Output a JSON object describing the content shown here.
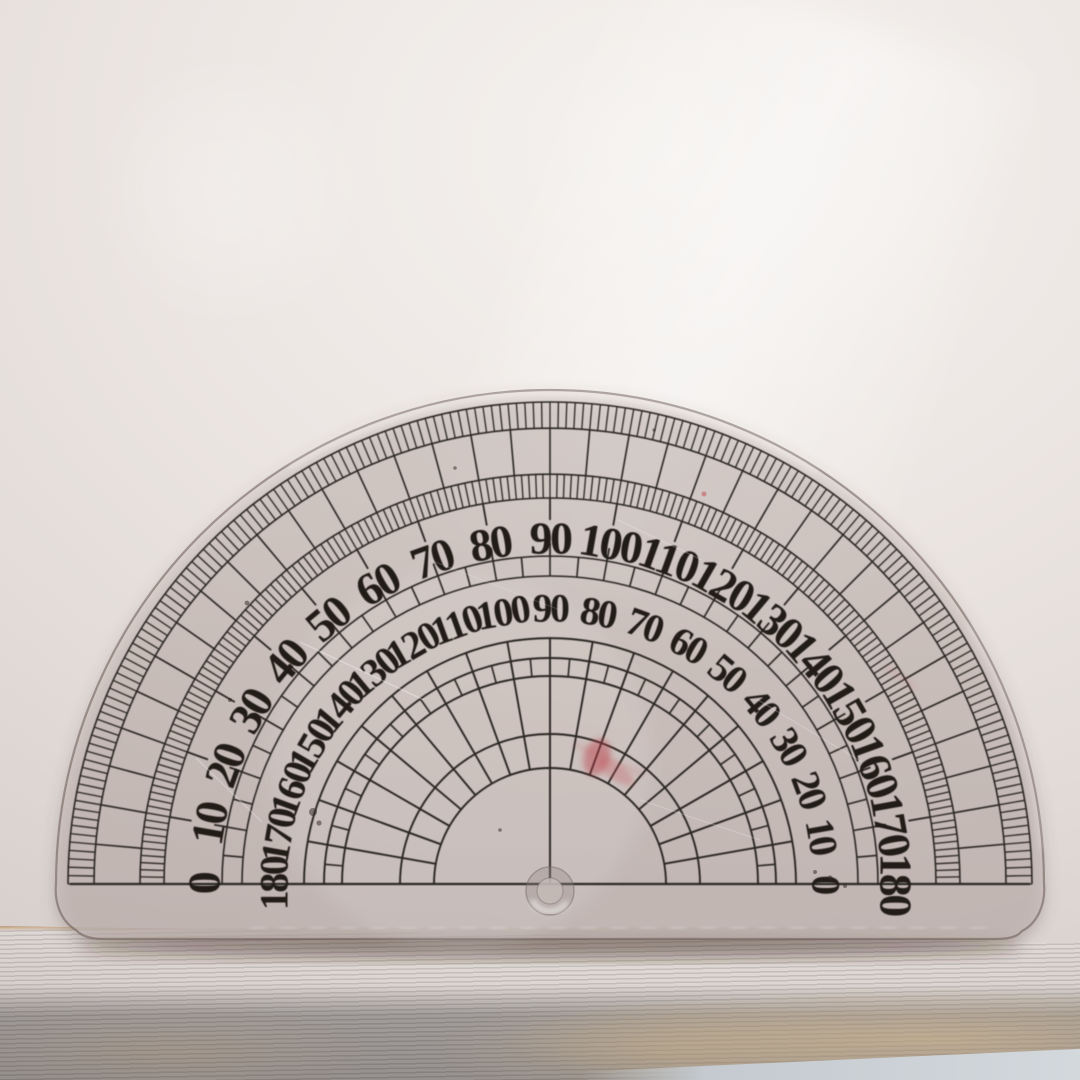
{
  "scene": {
    "description": "Photograph of a transparent semicircular protractor lying on light paper, resting on a brown wooden plank; pale table surface visible at bottom right.",
    "objects": [
      "paper-sheet",
      "semicircular-protractor",
      "wooden-plank",
      "table-surface"
    ]
  },
  "protractor": {
    "center": {
      "x": 550,
      "y": 884
    },
    "edge_radius": 494,
    "outer_scale": {
      "labels": [
        "0",
        "10",
        "20",
        "30",
        "40",
        "50",
        "60",
        "70",
        "80",
        "90",
        "100",
        "110",
        "120",
        "130",
        "140",
        "150",
        "160",
        "170",
        "180"
      ],
      "step_degrees": 10,
      "label_radius": 346,
      "font_size": 46
    },
    "inner_scale": {
      "labels": [
        "180",
        "170",
        "160",
        "150",
        "140",
        "130",
        "120",
        "110",
        "100",
        "90",
        "80",
        "70",
        "60",
        "50",
        "40",
        "30",
        "20",
        "10",
        "0"
      ],
      "step_degrees": 10,
      "label_radius": 276,
      "font_size": 40
    },
    "rings": {
      "arcs": [
        482,
        456,
        410,
        386,
        328,
        308,
        246,
        226,
        208,
        150,
        116
      ],
      "tick_sets": [
        {
          "name": "outer-fine-ticks-1deg",
          "ro": 482,
          "ri": 456,
          "step": 1,
          "w": 1.3,
          "skipEnds": false
        },
        {
          "name": "outer-box-band-5deg",
          "ro": 456,
          "ri": 410,
          "step": 5,
          "w": 1.6,
          "skipEnds": false
        },
        {
          "name": "inner-fine-ticks-1deg",
          "ro": 410,
          "ri": 386,
          "step": 1,
          "w": 1.3,
          "skipEnds": false
        },
        {
          "name": "ten-degree-ticks",
          "ro": 386,
          "ri": 364,
          "step": 10,
          "w": 1.8,
          "skipEnds": true
        },
        {
          "name": "mid-band-outward-ticks",
          "ro": 341,
          "ri": 328,
          "step": 10,
          "w": 1.8,
          "skipEnds": true
        },
        {
          "name": "mid-box-band-5deg",
          "ro": 328,
          "ri": 308,
          "step": 5,
          "w": 1.6,
          "skipEnds": true
        },
        {
          "name": "grid-sub-band-5deg",
          "ro": 226,
          "ri": 208,
          "step": 5,
          "w": 1.6,
          "skipEnds": true
        }
      ],
      "grid": {
        "outer_arc": 246,
        "inner_arc": 116,
        "step": 10
      }
    },
    "baseline": {
      "x1": 70,
      "x2": 1030,
      "y": 884
    },
    "center_hole": {
      "x": 550,
      "y": 891,
      "outer_r": 24,
      "inner_r": 13
    },
    "marks": {
      "red_stains": [
        {
          "type": "ellipse",
          "x": 597,
          "y": 757,
          "rx": 13,
          "ry": 19,
          "rot": 18,
          "fill": "rgba(186,58,68,0.42)"
        },
        {
          "type": "ellipse",
          "x": 616,
          "y": 772,
          "rx": 21,
          "ry": 8,
          "rot": 34,
          "fill": "rgba(198,80,90,0.30)"
        },
        {
          "type": "line",
          "x1": 574,
          "y1": 744,
          "x2": 643,
          "y2": 774,
          "w": 2,
          "stroke": "rgba(186,58,68,0.35)"
        },
        {
          "type": "line",
          "x1": 886,
          "y1": 667,
          "x2": 916,
          "y2": 688,
          "w": 2.5,
          "stroke": "rgba(205,95,105,0.28)"
        },
        {
          "type": "dot",
          "x": 704,
          "y": 494,
          "r": 2.5,
          "fill": "rgba(190,60,70,0.45)"
        }
      ],
      "dark_specks": [
        {
          "x": 313,
          "y": 812,
          "r": 4
        },
        {
          "x": 319,
          "y": 823,
          "r": 2.6
        },
        {
          "x": 830,
          "y": 878,
          "r": 2.6
        },
        {
          "x": 845,
          "y": 886,
          "r": 2
        },
        {
          "x": 815,
          "y": 872,
          "r": 2
        },
        {
          "x": 247,
          "y": 603,
          "r": 2.4
        },
        {
          "x": 455,
          "y": 468,
          "r": 1.8
        },
        {
          "x": 654,
          "y": 430,
          "r": 1.6
        },
        {
          "x": 230,
          "y": 700,
          "r": 2.0
        },
        {
          "x": 500,
          "y": 830,
          "r": 1.8
        }
      ],
      "scratches": [
        {
          "x1": 300,
          "y1": 642,
          "x2": 424,
          "y2": 700,
          "w": 1.5,
          "stroke": "rgba(255,255,255,0.30)"
        },
        {
          "x1": 618,
          "y1": 520,
          "x2": 702,
          "y2": 560,
          "w": 1.2,
          "stroke": "rgba(255,255,255,0.22)"
        },
        {
          "x1": 196,
          "y1": 758,
          "x2": 262,
          "y2": 822,
          "w": 1.3,
          "stroke": "rgba(255,255,255,0.26)"
        },
        {
          "x1": 758,
          "y1": 700,
          "x2": 862,
          "y2": 762,
          "w": 1.2,
          "stroke": "rgba(255,255,255,0.20)"
        },
        {
          "x1": 430,
          "y1": 560,
          "x2": 560,
          "y2": 610,
          "w": 1.0,
          "stroke": "rgba(255,255,255,0.16)"
        },
        {
          "x1": 640,
          "y1": 800,
          "x2": 760,
          "y2": 840,
          "w": 1.2,
          "stroke": "rgba(255,255,255,0.20)"
        }
      ]
    },
    "colors": {
      "ink": "#2b2623",
      "numbers": "#201b18",
      "plastic_edge": "rgba(105,90,83,0.55)"
    }
  }
}
